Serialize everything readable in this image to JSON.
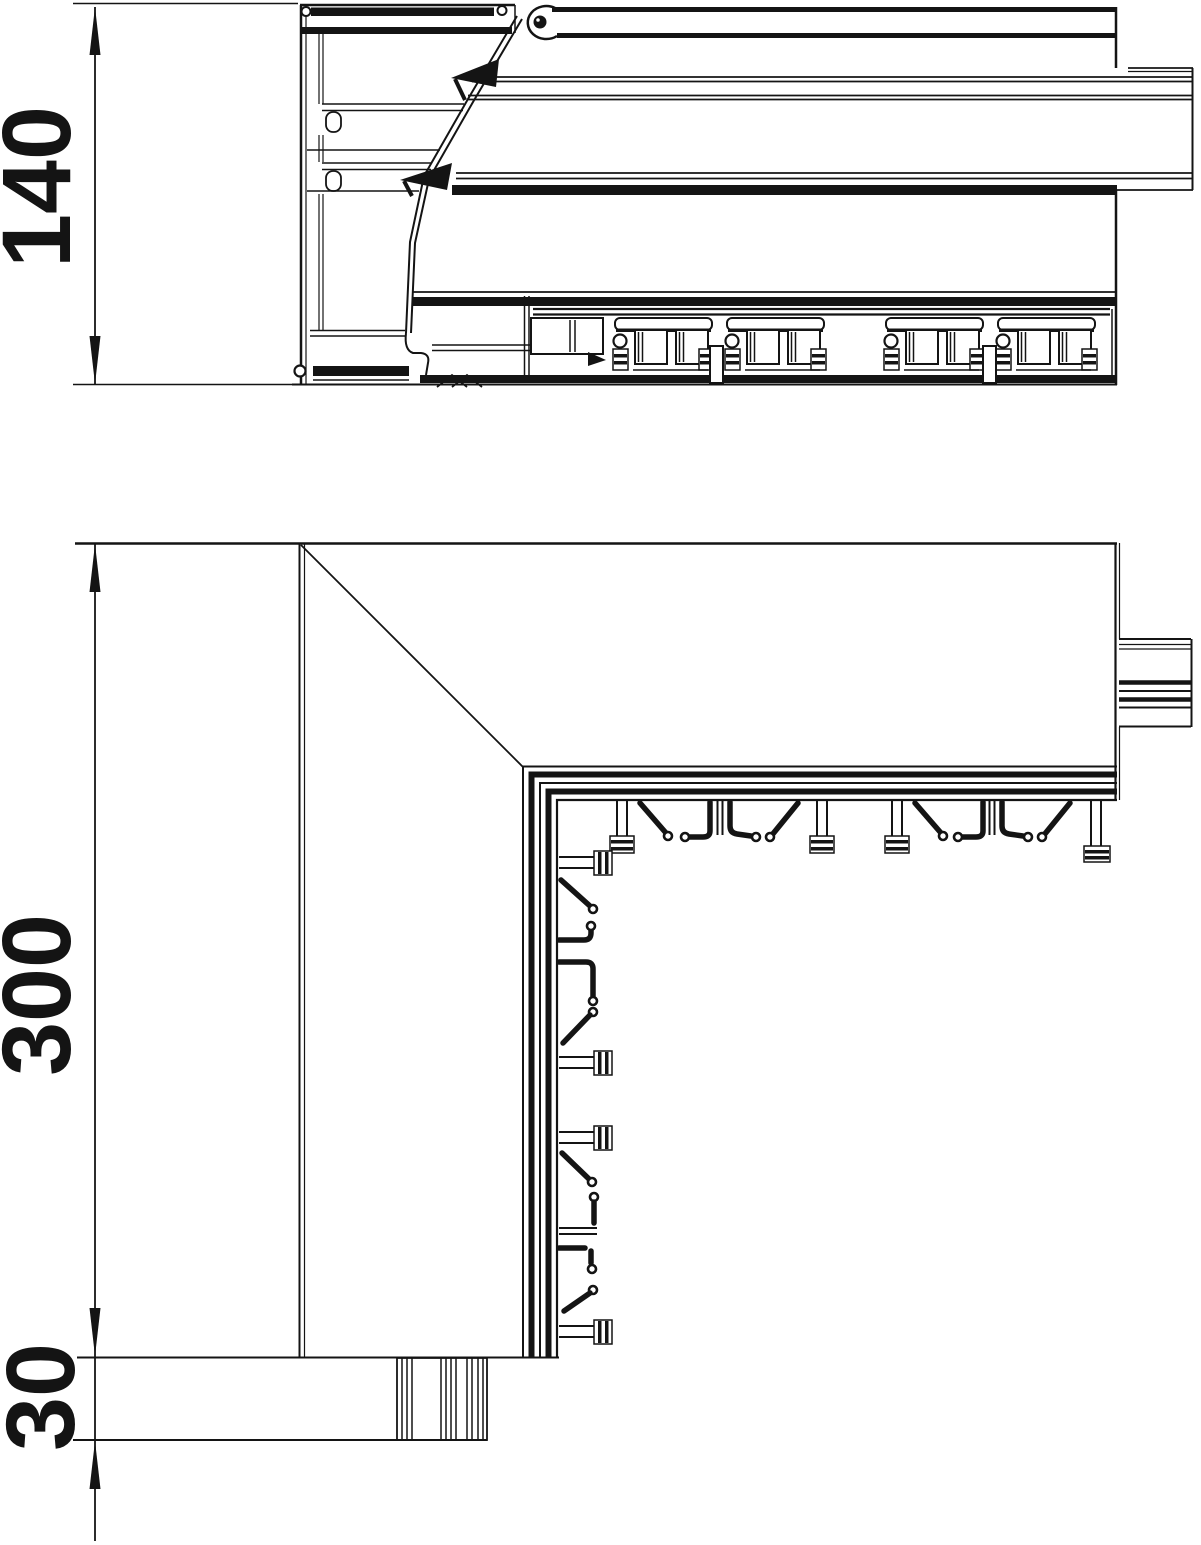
{
  "page": {
    "title": "Technical dimensional drawing - trunking internal corner",
    "background": "#ffffff",
    "line_color": "#141414"
  },
  "views": {
    "cross_section": {
      "label": "cross-section profile"
    },
    "plan": {
      "label": "plan view of corner"
    }
  },
  "dimensions": {
    "height": {
      "value": "140"
    },
    "length": {
      "value": "300"
    },
    "offset": {
      "value": "30"
    }
  }
}
